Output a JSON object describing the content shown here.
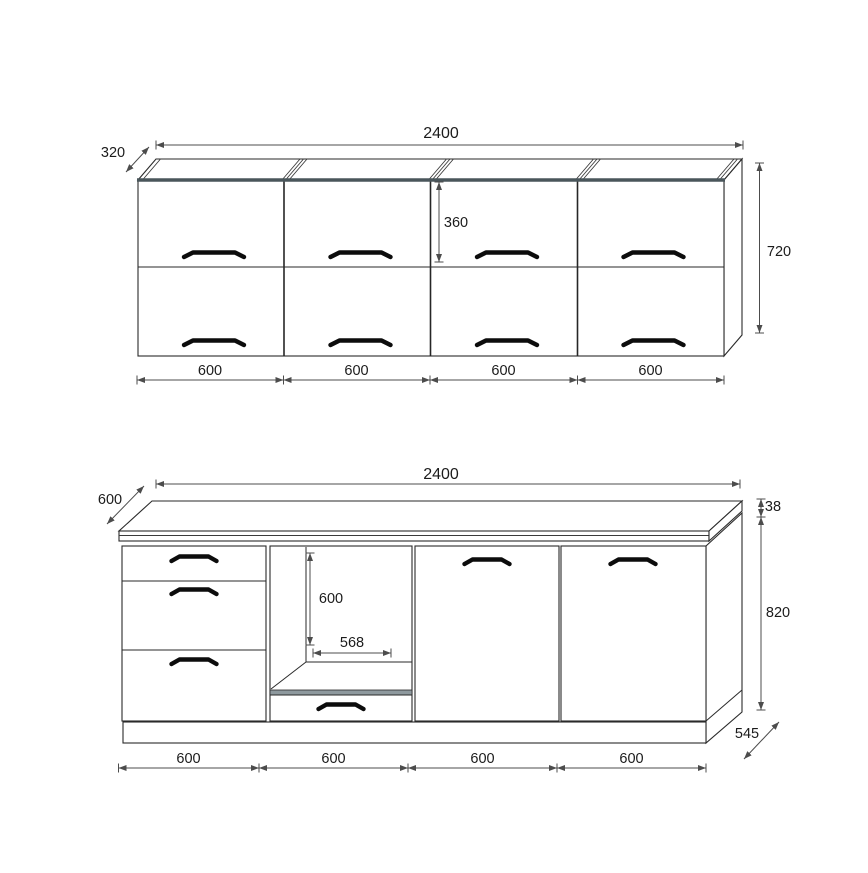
{
  "page": {
    "background": "#ffffff",
    "description_labels": {
      "drawing_type": "kitchen-cabinet-dimension-drawing"
    }
  },
  "colors": {
    "line": "#2a2a2a",
    "dimension_line": "#4c4c4c",
    "text": "#1b1b1b",
    "thick_front_edge": "#4a565b",
    "shelf_band": "#8e999e",
    "handle": "#0c0c0c"
  },
  "wall_cabinet_drawing": {
    "dim_total_width": "2400",
    "dim_depth": "320",
    "dim_height": "720",
    "dim_upper_door_height": "360",
    "dim_sections": [
      "600",
      "600",
      "600",
      "600"
    ]
  },
  "base_cabinet_drawing": {
    "dim_total_width": "2400",
    "dim_depth": "600",
    "dim_worktop_thickness": "38",
    "dim_height": "820",
    "dim_plinth_depth": "545",
    "dim_niche_height": "600",
    "dim_niche_width": "568",
    "dim_sections": [
      "600",
      "600",
      "600",
      "600"
    ]
  }
}
